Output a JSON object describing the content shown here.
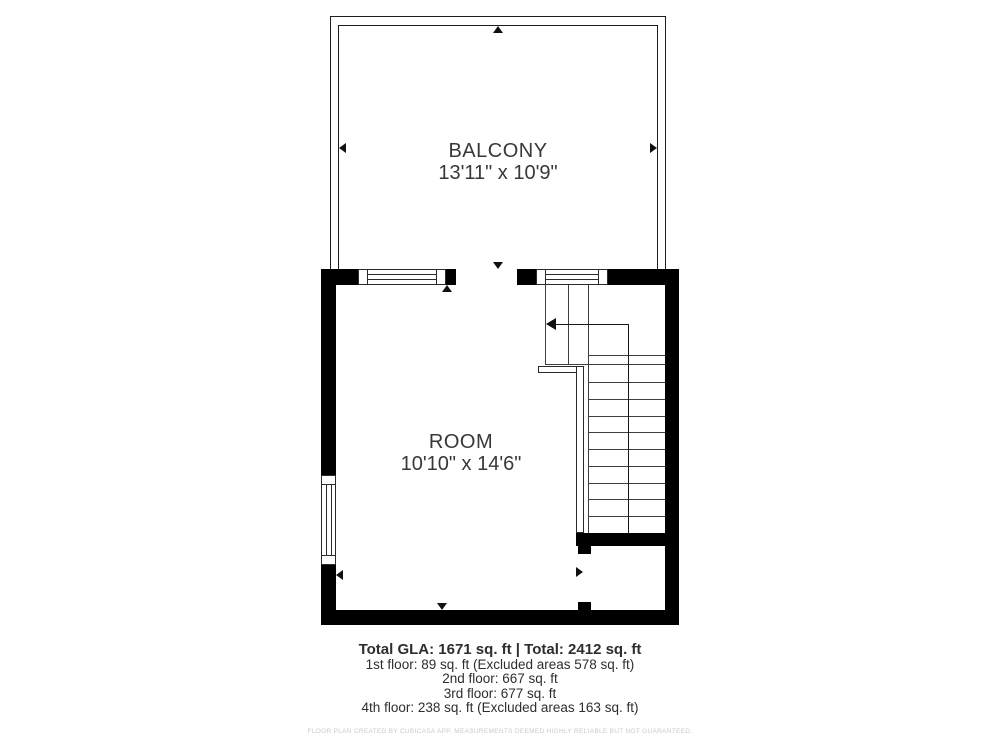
{
  "plan": {
    "balcony": {
      "label": "BALCONY",
      "dimensions": "13'11\" x 10'9\""
    },
    "room": {
      "label": "ROOM",
      "dimensions": "10'10\" x 14'6\""
    },
    "features": [
      "staircase",
      "window-top-left",
      "window-top-right",
      "window-left",
      "balcony-opening",
      "under-stair-closet-opening"
    ]
  },
  "summary": {
    "total_line": "Total GLA: 1671 sq. ft | Total: 2412 sq. ft",
    "floors": [
      "1st floor: 89 sq. ft (Excluded areas 578 sq. ft)",
      "2nd floor: 667 sq. ft",
      "3rd floor: 677 sq. ft",
      "4th floor: 238 sq. ft (Excluded areas 163 sq. ft)"
    ],
    "disclaimer": "FLOOR PLAN CREATED BY CUBICASA APP. MEASUREMENTS DEEMED HIGHLY RELIABLE BUT NOT GUARANTEED."
  },
  "colors": {
    "wall": "#000000",
    "thin_line": "#3e3e3e",
    "text": "#2e2e2e",
    "disclaimer_text": "#c9c9c9",
    "background": "#ffffff"
  }
}
